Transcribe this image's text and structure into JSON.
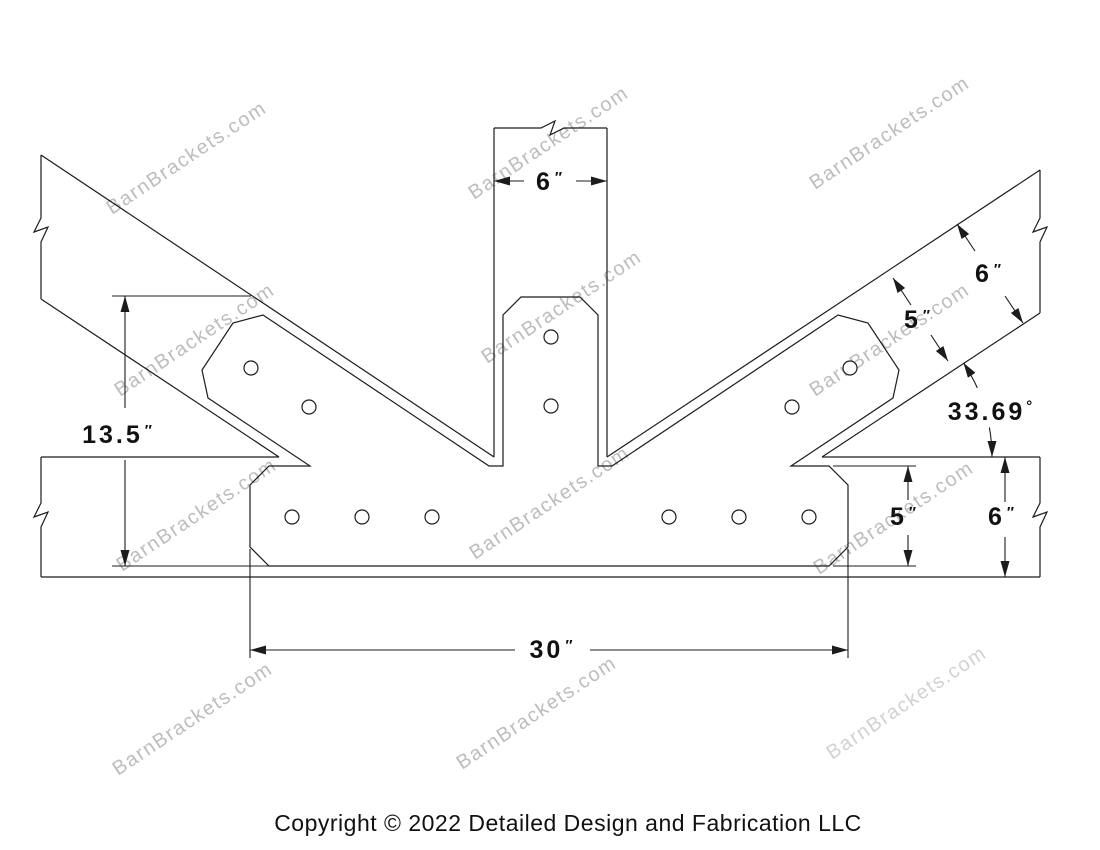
{
  "watermark": {
    "text": "BarnBrackets.com"
  },
  "dimensions": {
    "post_width": {
      "value": "6",
      "unit": "″"
    },
    "rafter_depth": {
      "value": "6",
      "unit": "″"
    },
    "rafter_strap_width": {
      "value": "5",
      "unit": "″"
    },
    "rafter_angle": {
      "value": "33.69",
      "unit": "°"
    },
    "bracket_height": {
      "value": "13.5",
      "unit": "″"
    },
    "beam_strap_width": {
      "value": "5",
      "unit": "″"
    },
    "beam_depth": {
      "value": "6",
      "unit": "″"
    },
    "bracket_length": {
      "value": "30",
      "unit": "″"
    }
  },
  "footer": {
    "copyright": "Copyright © 2022 Detailed Design and Fabrication LLC"
  },
  "colors": {
    "line": "#1c1c1c",
    "dim_text": "#111111",
    "watermark": "#bdbdbd",
    "background": "#ffffff"
  }
}
